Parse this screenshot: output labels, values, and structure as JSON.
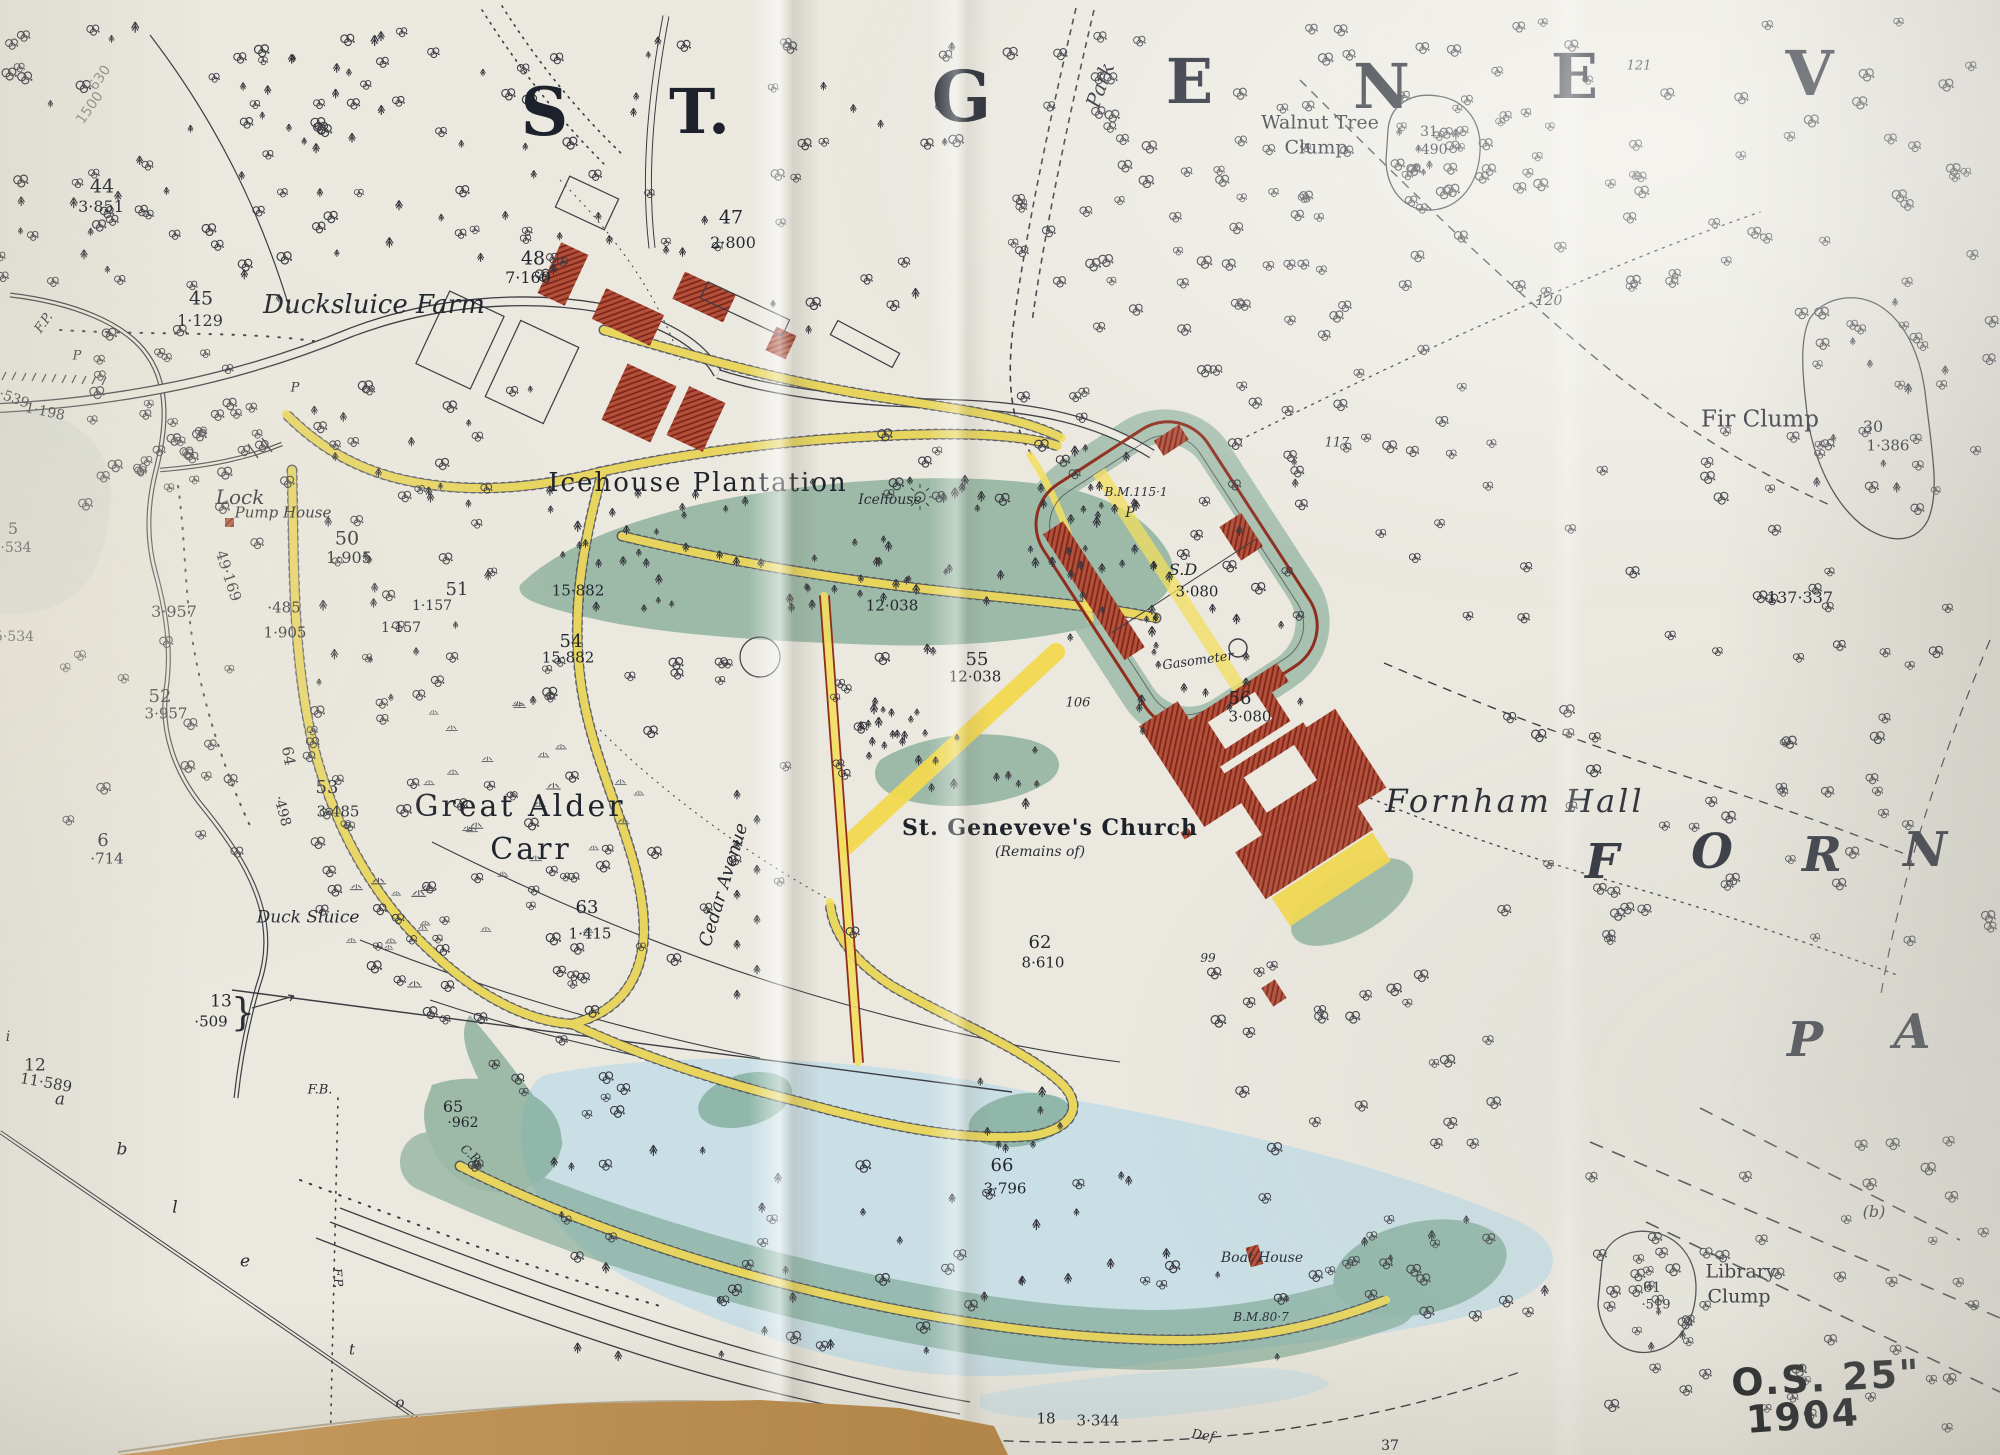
{
  "meta": {
    "kind": "Photograph of an Ordnance Survey 25-inch map sheet laid on a desk",
    "annotation_series": "O.S. 25\"",
    "annotation_year": "1904",
    "sheet_title_fragment": "ST. GENEV",
    "district_letters": "FORN / PA"
  },
  "colors": {
    "paper": "#eae8df",
    "ink": "#3b3c42",
    "road_yellow": "#f3df5e",
    "building_red": "#a93f2c",
    "wall_red": "#8f2e1f",
    "wood_green": "#6f9e87",
    "water_blue": "#c6dde6",
    "desk_brown": "#b5884c"
  },
  "labels": [
    {
      "t": "S",
      "x": 545,
      "y": 112,
      "c": "hg",
      "s": 66
    },
    {
      "t": "T.",
      "x": 700,
      "y": 112,
      "c": "hg",
      "s": 62
    },
    {
      "t": "G",
      "x": 962,
      "y": 97,
      "c": "hg",
      "s": 70
    },
    {
      "t": "E",
      "x": 1190,
      "y": 82,
      "c": "hg",
      "s": 62
    },
    {
      "t": "N",
      "x": 1382,
      "y": 87,
      "c": "hg",
      "s": 62
    },
    {
      "t": "E",
      "x": 1575,
      "y": 77,
      "c": "hg",
      "s": 62
    },
    {
      "t": "V",
      "x": 1810,
      "y": 74,
      "c": "hg",
      "s": 62
    },
    {
      "t": "Park",
      "x": 1100,
      "y": 85,
      "c": "it",
      "s": 20,
      "r": -70
    },
    {
      "t": "121",
      "x": 1639,
      "y": 66,
      "c": "itsm",
      "s": 13
    },
    {
      "t": "Walnut Tree",
      "x": 1320,
      "y": 123,
      "c": "nm",
      "s": 19
    },
    {
      "t": "Clump",
      "x": 1316,
      "y": 148,
      "c": "nm",
      "s": 19
    },
    {
      "t": "31",
      "x": 1429,
      "y": 132,
      "c": "num",
      "s": 14
    },
    {
      "t": "·490",
      "x": 1432,
      "y": 150,
      "c": "num",
      "s": 14
    },
    {
      "t": "120",
      "x": 1549,
      "y": 301,
      "c": "itsm",
      "s": 14
    },
    {
      "t": "117",
      "x": 1337,
      "y": 443,
      "c": "itsm",
      "s": 13
    },
    {
      "t": "Fir Clump",
      "x": 1760,
      "y": 420,
      "c": "nm",
      "s": 23
    },
    {
      "t": "30",
      "x": 1873,
      "y": 427,
      "c": "num",
      "s": 16
    },
    {
      "t": "1·386",
      "x": 1888,
      "y": 446,
      "c": "num",
      "s": 15
    },
    {
      "t": "137·337",
      "x": 1800,
      "y": 598,
      "c": "num",
      "s": 16
    },
    {
      "t": "44",
      "x": 102,
      "y": 187,
      "c": "num",
      "s": 19
    },
    {
      "t": "3·851",
      "x": 101,
      "y": 207,
      "c": "num",
      "s": 16
    },
    {
      "t": "45",
      "x": 201,
      "y": 299,
      "c": "num",
      "s": 19
    },
    {
      "t": "1·129",
      "x": 200,
      "y": 321,
      "c": "num",
      "s": 16
    },
    {
      "t": "Ducksluice Farm",
      "x": 374,
      "y": 305,
      "c": "it",
      "s": 26
    },
    {
      "t": "F.P.",
      "x": 44,
      "y": 323,
      "c": "itsm",
      "s": 13,
      "r": -55
    },
    {
      "t": "P",
      "x": 77,
      "y": 356,
      "c": "itsm",
      "s": 13
    },
    {
      "t": "P",
      "x": 295,
      "y": 388,
      "c": "itsm",
      "s": 13
    },
    {
      "t": "47",
      "x": 731,
      "y": 218,
      "c": "num",
      "s": 19
    },
    {
      "t": "2·800",
      "x": 733,
      "y": 243,
      "c": "num",
      "s": 16
    },
    {
      "t": "48",
      "x": 533,
      "y": 259,
      "c": "num",
      "s": 19
    },
    {
      "t": "7·160",
      "x": 528,
      "y": 278,
      "c": "num",
      "s": 16
    },
    {
      "t": "·539",
      "x": 14,
      "y": 399,
      "c": "num",
      "s": 14,
      "r": 20
    },
    {
      "t": "1·198",
      "x": 45,
      "y": 412,
      "c": "num",
      "s": 14,
      "r": 12
    },
    {
      "t": "Lock",
      "x": 240,
      "y": 497,
      "c": "it",
      "s": 20
    },
    {
      "t": "Pump House",
      "x": 283,
      "y": 513,
      "c": "it",
      "s": 15
    },
    {
      "t": "49·169",
      "x": 228,
      "y": 576,
      "c": "num",
      "s": 15,
      "r": 72
    },
    {
      "t": "50",
      "x": 347,
      "y": 539,
      "c": "num",
      "s": 19
    },
    {
      "t": "1·905",
      "x": 349,
      "y": 558,
      "c": "num",
      "s": 16
    },
    {
      "t": "·485",
      "x": 284,
      "y": 608,
      "c": "num",
      "s": 15
    },
    {
      "t": "1·905",
      "x": 285,
      "y": 633,
      "c": "num",
      "s": 15
    },
    {
      "t": "3·957",
      "x": 174,
      "y": 612,
      "c": "num",
      "s": 16
    },
    {
      "t": "5",
      "x": 13,
      "y": 529,
      "c": "num",
      "s": 16
    },
    {
      "t": "·534",
      "x": 16,
      "y": 548,
      "c": "num",
      "s": 14
    },
    {
      "t": "5·534",
      "x": 14,
      "y": 637,
      "c": "num",
      "s": 14
    },
    {
      "t": "51",
      "x": 457,
      "y": 590,
      "c": "num",
      "s": 18
    },
    {
      "t": "1·157",
      "x": 432,
      "y": 606,
      "c": "num",
      "s": 14
    },
    {
      "t": "1·157",
      "x": 401,
      "y": 628,
      "c": "num",
      "s": 14
    },
    {
      "t": "52",
      "x": 160,
      "y": 697,
      "c": "num",
      "s": 18
    },
    {
      "t": "3·957",
      "x": 166,
      "y": 714,
      "c": "num",
      "s": 15
    },
    {
      "t": "Icehouse Plantation",
      "x": 698,
      "y": 483,
      "c": "nm",
      "s": 26,
      "ls": 2
    },
    {
      "t": "Icehouse",
      "x": 890,
      "y": 500,
      "c": "itsm",
      "s": 14
    },
    {
      "t": "15·882",
      "x": 578,
      "y": 591,
      "c": "num",
      "s": 15
    },
    {
      "t": "54",
      "x": 571,
      "y": 642,
      "c": "num",
      "s": 18
    },
    {
      "t": "15·882",
      "x": 568,
      "y": 658,
      "c": "num",
      "s": 15
    },
    {
      "t": "12·038",
      "x": 892,
      "y": 606,
      "c": "num",
      "s": 15
    },
    {
      "t": "55",
      "x": 977,
      "y": 660,
      "c": "num",
      "s": 18
    },
    {
      "t": "12·038",
      "x": 975,
      "y": 677,
      "c": "num",
      "s": 15
    },
    {
      "t": "B.M.115·1",
      "x": 1136,
      "y": 492,
      "c": "itsm",
      "s": 12
    },
    {
      "t": "P",
      "x": 1130,
      "y": 513,
      "c": "itsm",
      "s": 14
    },
    {
      "t": "S.D",
      "x": 1183,
      "y": 570,
      "c": "it",
      "s": 16
    },
    {
      "t": "3·080",
      "x": 1197,
      "y": 592,
      "c": "num",
      "s": 15
    },
    {
      "t": "Gasometer",
      "x": 1198,
      "y": 661,
      "c": "itsm",
      "s": 13,
      "r": -8
    },
    {
      "t": "56",
      "x": 1240,
      "y": 699,
      "c": "num",
      "s": 18
    },
    {
      "t": "3·080",
      "x": 1250,
      "y": 717,
      "c": "num",
      "s": 15
    },
    {
      "t": "106",
      "x": 1078,
      "y": 703,
      "c": "itsm",
      "s": 13
    },
    {
      "t": "6",
      "x": 103,
      "y": 841,
      "c": "num",
      "s": 18
    },
    {
      "t": "·714",
      "x": 107,
      "y": 859,
      "c": "num",
      "s": 15
    },
    {
      "t": "64",
      "x": 288,
      "y": 756,
      "c": "num",
      "s": 15,
      "r": 80
    },
    {
      "t": "·498",
      "x": 282,
      "y": 811,
      "c": "num",
      "s": 14,
      "r": 75
    },
    {
      "t": "53",
      "x": 327,
      "y": 788,
      "c": "num",
      "s": 18
    },
    {
      "t": "3·485",
      "x": 338,
      "y": 812,
      "c": "num",
      "s": 15
    },
    {
      "t": "Great Alder",
      "x": 520,
      "y": 807,
      "c": "nm",
      "s": 30,
      "ls": 3
    },
    {
      "t": "Carr",
      "x": 531,
      "y": 850,
      "c": "nm",
      "s": 30,
      "ls": 3
    },
    {
      "t": "Cedar Avenue",
      "x": 724,
      "y": 885,
      "c": "it",
      "s": 18,
      "r": -73
    },
    {
      "t": "Duck Sluice",
      "x": 308,
      "y": 918,
      "c": "it",
      "s": 17
    },
    {
      "t": "63",
      "x": 587,
      "y": 908,
      "c": "num",
      "s": 18
    },
    {
      "t": "1·415",
      "x": 590,
      "y": 934,
      "c": "num",
      "s": 15
    },
    {
      "t": "St. Geneveve's Church",
      "x": 1050,
      "y": 828,
      "c": "bl",
      "s": 22
    },
    {
      "t": "(Remains of)",
      "x": 1040,
      "y": 852,
      "c": "itsm",
      "s": 14
    },
    {
      "t": "Fornham Hall",
      "x": 1515,
      "y": 801,
      "c": "it",
      "s": 32,
      "ls": 3
    },
    {
      "t": "99",
      "x": 1208,
      "y": 958,
      "c": "itsm",
      "s": 12
    },
    {
      "t": "62",
      "x": 1040,
      "y": 943,
      "c": "num",
      "s": 18
    },
    {
      "t": "8·610",
      "x": 1043,
      "y": 963,
      "c": "num",
      "s": 15
    },
    {
      "t": "F",
      "x": 1602,
      "y": 862,
      "c": "hi",
      "s": 48
    },
    {
      "t": "O",
      "x": 1712,
      "y": 852,
      "c": "hi",
      "s": 48
    },
    {
      "t": "R",
      "x": 1822,
      "y": 855,
      "c": "hi",
      "s": 48
    },
    {
      "t": "N",
      "x": 1925,
      "y": 850,
      "c": "hi",
      "s": 48
    },
    {
      "t": "P",
      "x": 1805,
      "y": 1040,
      "c": "hi",
      "s": 48
    },
    {
      "t": "A",
      "x": 1912,
      "y": 1032,
      "c": "hi",
      "s": 48
    },
    {
      "t": "F.B.",
      "x": 320,
      "y": 1090,
      "c": "itsm",
      "s": 13
    },
    {
      "t": "13",
      "x": 221,
      "y": 1002,
      "c": "num",
      "s": 17
    },
    {
      "t": "·509",
      "x": 211,
      "y": 1022,
      "c": "num",
      "s": 15
    },
    {
      "t": "}",
      "x": 243,
      "y": 1012,
      "c": "brace",
      "s": 38
    },
    {
      "t": "12",
      "x": 35,
      "y": 1066,
      "c": "num",
      "s": 17
    },
    {
      "t": "11·589",
      "x": 46,
      "y": 1083,
      "c": "num",
      "s": 15,
      "r": 10
    },
    {
      "t": "i",
      "x": 8,
      "y": 1037,
      "c": "itsm",
      "s": 14
    },
    {
      "t": "a",
      "x": 60,
      "y": 1100,
      "c": "it",
      "s": 17
    },
    {
      "t": "b",
      "x": 122,
      "y": 1150,
      "c": "it",
      "s": 17
    },
    {
      "t": "l",
      "x": 175,
      "y": 1208,
      "c": "it",
      "s": 17
    },
    {
      "t": "e",
      "x": 245,
      "y": 1262,
      "c": "it",
      "s": 17
    },
    {
      "t": "t",
      "x": 352,
      "y": 1350,
      "c": "itsm",
      "s": 15
    },
    {
      "t": "o",
      "x": 400,
      "y": 1403,
      "c": "itsm",
      "s": 15
    },
    {
      "t": "65",
      "x": 453,
      "y": 1107,
      "c": "num",
      "s": 16
    },
    {
      "t": "·962",
      "x": 463,
      "y": 1123,
      "c": "num",
      "s": 14
    },
    {
      "t": "C.R.",
      "x": 472,
      "y": 1155,
      "c": "itsm",
      "s": 12,
      "r": 40
    },
    {
      "t": "F.P.",
      "x": 338,
      "y": 1278,
      "c": "itsm",
      "s": 12,
      "r": 85
    },
    {
      "t": "66",
      "x": 1002,
      "y": 1166,
      "c": "num",
      "s": 18
    },
    {
      "t": "3·796",
      "x": 1005,
      "y": 1189,
      "c": "num",
      "s": 15
    },
    {
      "t": "Boat House",
      "x": 1262,
      "y": 1258,
      "c": "itsm",
      "s": 14
    },
    {
      "t": "B.M.80·7",
      "x": 1261,
      "y": 1317,
      "c": "itsm",
      "s": 12
    },
    {
      "t": "Def",
      "x": 1203,
      "y": 1436,
      "c": "itsm",
      "s": 13,
      "r": 8
    },
    {
      "t": "18",
      "x": 1046,
      "y": 1419,
      "c": "num",
      "s": 15
    },
    {
      "t": "3·344",
      "x": 1098,
      "y": 1421,
      "c": "num",
      "s": 15
    },
    {
      "t": "17",
      "x": 790,
      "y": 1447,
      "c": "num",
      "s": 15
    },
    {
      "t": "}",
      "x": 812,
      "y": 1446,
      "c": "brace",
      "s": 24
    },
    {
      "t": "37",
      "x": 1390,
      "y": 1446,
      "c": "num",
      "s": 14
    },
    {
      "t": "Library",
      "x": 1741,
      "y": 1272,
      "c": "nm",
      "s": 19
    },
    {
      "t": "Clump",
      "x": 1739,
      "y": 1297,
      "c": "nm",
      "s": 19
    },
    {
      "t": "61",
      "x": 1652,
      "y": 1288,
      "c": "num",
      "s": 14
    },
    {
      "t": "·519",
      "x": 1656,
      "y": 1305,
      "c": "num",
      "s": 13
    },
    {
      "t": "(b)",
      "x": 1874,
      "y": 1212,
      "c": "it",
      "s": 16
    },
    {
      "t": "O.S. 25\"",
      "x": 1826,
      "y": 1378,
      "c": "hand",
      "s": 38,
      "r": -3
    },
    {
      "t": "1904",
      "x": 1803,
      "y": 1416,
      "c": "hand",
      "s": 38,
      "r": -4
    },
    {
      "t": "630",
      "x": 100,
      "y": 78,
      "c": "pencil",
      "s": 14,
      "r": -55
    },
    {
      "t": "1500",
      "x": 90,
      "y": 108,
      "c": "pencil",
      "s": 14,
      "r": -55
    }
  ]
}
